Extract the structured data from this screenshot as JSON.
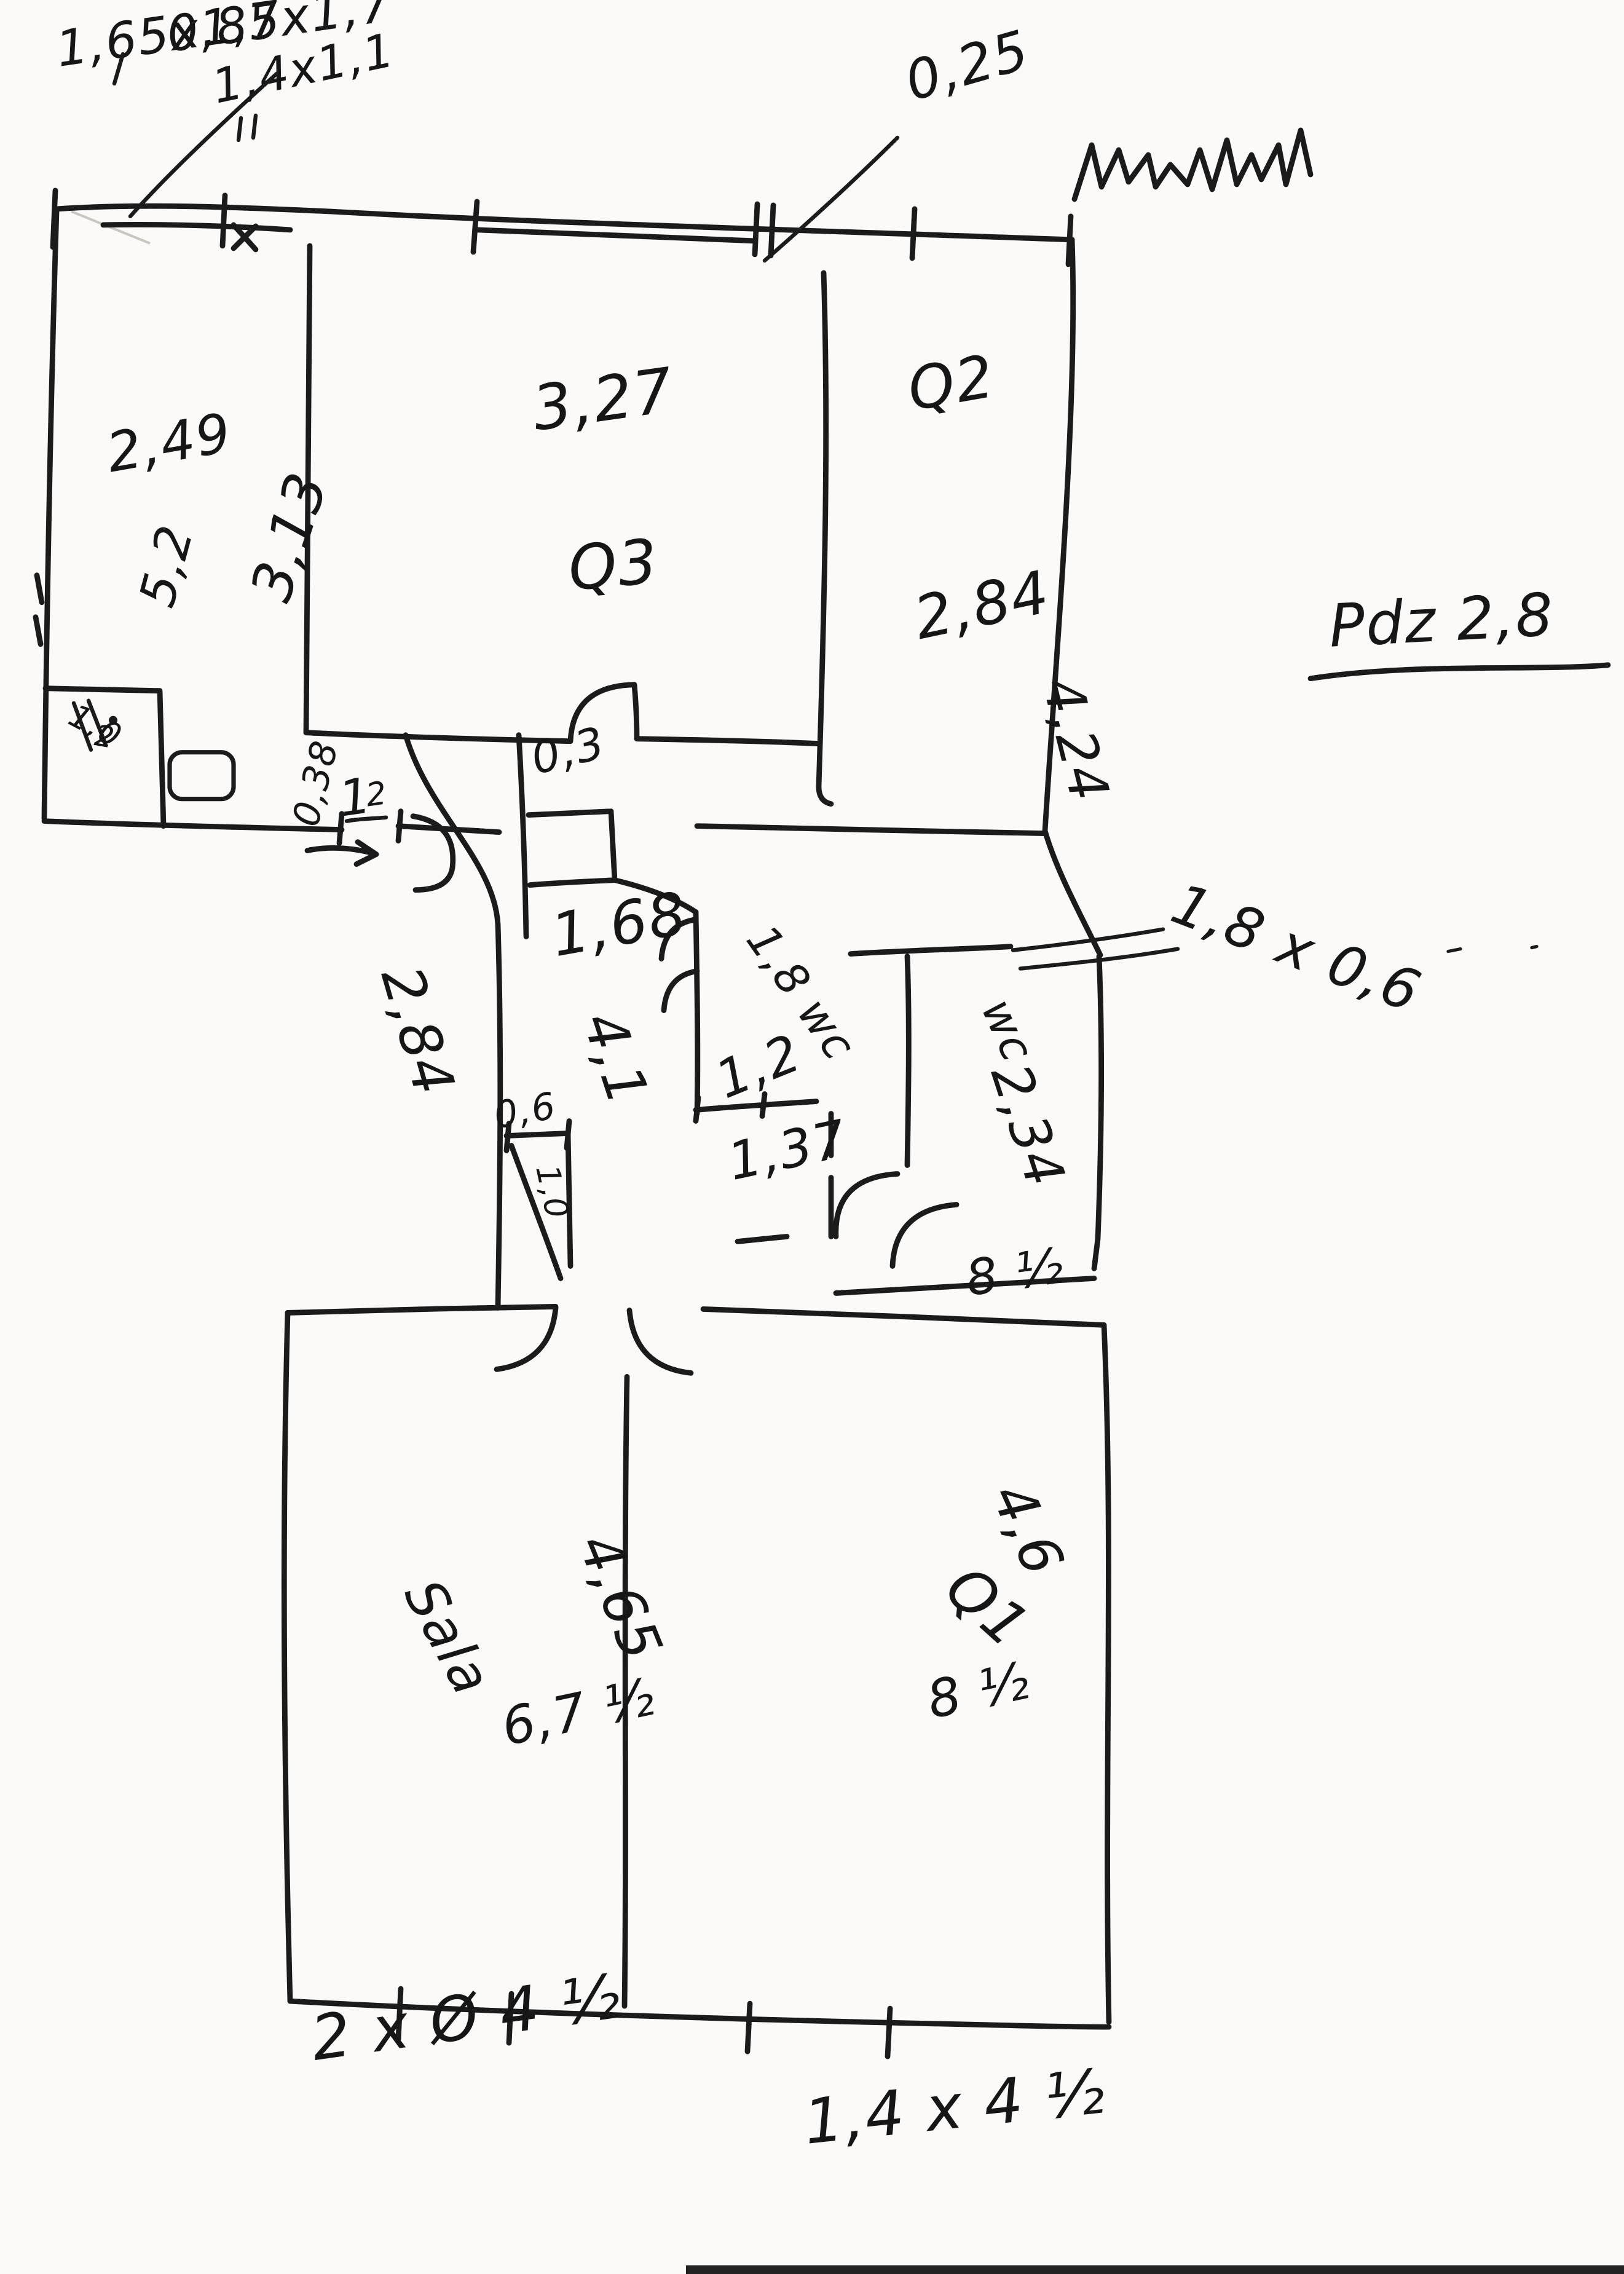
{
  "meta": {
    "title": "Hand-drawn apartment floor plan sketch",
    "medium": "black ink on white paper",
    "top_right_scribble": "illegible cursive word"
  },
  "palette": {
    "paper": "#fbfaf8",
    "ink": "#1b1b1b",
    "scan_edge": "#222222"
  },
  "labels": {
    "win_a": "1,65x1,7",
    "win_b": "0,85x1,7",
    "win_c": "1,4x1,1",
    "wall_thickness": "0,25",
    "note": "Pdz 2,8",
    "r1_width": "2,49",
    "r1_height": "5,2",
    "r1_niche_a": "1,0",
    "r1_niche_b": "2",
    "q3_width": "3,27",
    "q3_height": "3,13",
    "q3_name": "Q3",
    "q2_name": "Q2",
    "q2_width": "2,84",
    "q2_height": "4,24",
    "dim_038": "0,38",
    "dim_1": "1",
    "dim_2": "2",
    "dim_03": "0,3",
    "bath_width": "1,68",
    "bath_diag": "1,8 wc",
    "bath_12": "1,2",
    "bath_137": "1,37",
    "hall_width": "2,84",
    "hall_height": "4,1",
    "hall_niche": "0,6",
    "hall_niche_b": "1,0",
    "wc_name": "wc",
    "wc_height": "2,34",
    "wc_door": "1,8 x 0,6",
    "wc_85": "8 ½",
    "sala_name": "Sala",
    "sala_height": "4,65",
    "sala_width": "6,7 ½",
    "q1_name": "Q1",
    "q1_height": "4,6",
    "q1_width": "8 ½",
    "win_bottom_left": "2 x Ø 4 ½",
    "win_bottom_right": "1,4 x 4 ½"
  }
}
